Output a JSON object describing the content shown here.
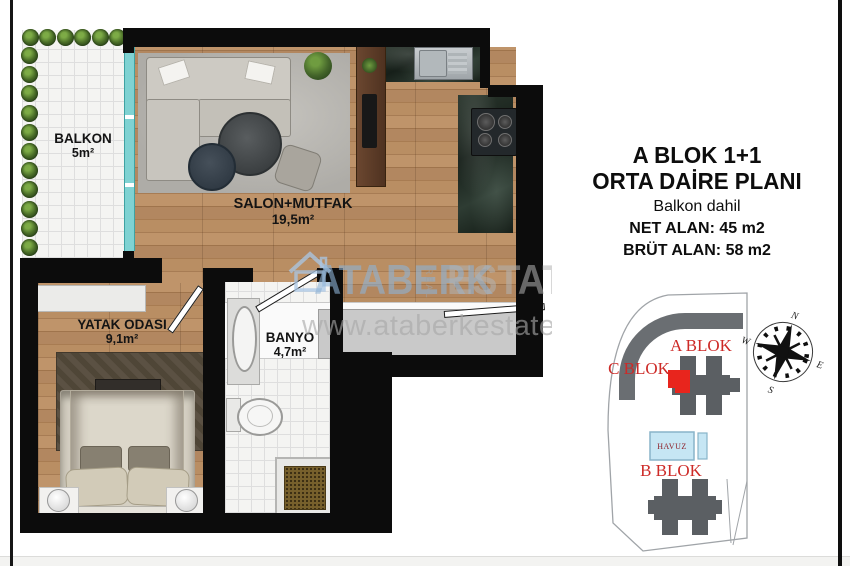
{
  "info_panel": {
    "title_line1": "A BLOK 1+1",
    "title_line2": "ORTA DAİRE PLANI",
    "subtitle": "Balkon dahil",
    "net_area": "NET ALAN: 45 m2",
    "gross_area": "BRÜT ALAN: 58 m2"
  },
  "floorplan": {
    "rooms": {
      "balkon": {
        "name": "BALKON",
        "area": "5m²"
      },
      "salon": {
        "name": "SALON+MUTFAK",
        "area": "19,5m²"
      },
      "yatak_odasi": {
        "name": "YATAK ODASI",
        "area": "9,1m²"
      },
      "banyo": {
        "name": "BANYO",
        "area": "4,7m²"
      }
    }
  },
  "watermark": {
    "brand_part1": "ATABERK",
    "brand_vertical": "REAL",
    "brand_part2": "ESTATE",
    "website": "www.ataberkestate.co"
  },
  "site_plan": {
    "blocks": {
      "a": "A BLOK",
      "b": "B BLOK",
      "c": "C BLOK"
    },
    "pool_label": "HAVUZ",
    "compass": {
      "north": "N",
      "south": "S",
      "east": "E",
      "west": "W"
    }
  },
  "colors": {
    "highlight_unit": "#e8251d",
    "block_label_red": "#cd2a27",
    "building_gray": "#5b5f63",
    "pool_fill": "#c6e6f4",
    "glass_teal": "#7ed0d0"
  }
}
